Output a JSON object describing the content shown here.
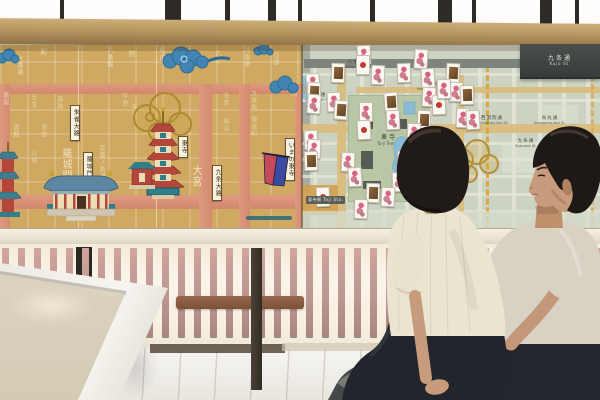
{
  "colors": {
    "beam_wood": "#b6945e",
    "historical_map_bg": "#cfa961",
    "historical_road": "#d48a6f",
    "modern_map_bg": "#ccd3c3",
    "modern_tan_street": "#d9bd7e",
    "park_green": "#b9c7a6",
    "water_blue": "#8fc0d8",
    "cloud_blue": "#4285b2",
    "pagoda_red": "#b4473c",
    "accent_teal": "#2e7f8a",
    "baluster_pink": "#bd968e",
    "bench_gray": "#45484b",
    "woman_top_cream": "#ebe4d1",
    "man_tee_gray": "#d8d2c4"
  },
  "room": {
    "window_mullions": [
      {
        "x": 60,
        "w": 4
      },
      {
        "x": 165,
        "w": 16
      },
      {
        "x": 225,
        "w": 5
      },
      {
        "x": 268,
        "w": 8
      },
      {
        "x": 298,
        "w": 4
      },
      {
        "x": 370,
        "w": 5
      },
      {
        "x": 438,
        "w": 14
      },
      {
        "x": 472,
        "w": 4
      },
      {
        "x": 540,
        "w": 12
      },
      {
        "x": 575,
        "w": 4
      }
    ]
  },
  "mural": {
    "historical_map": {
      "labels": [
        {
          "x": 70,
          "y": 60,
          "text": "朱雀大路"
        },
        {
          "x": 83,
          "y": 107,
          "text": "羅城門"
        },
        {
          "x": 178,
          "y": 91,
          "text": "東寺"
        },
        {
          "x": 212,
          "y": 120,
          "text": "九条大路"
        },
        {
          "x": 285,
          "y": 93,
          "text": "いまの東寺"
        }
      ],
      "kanji": [
        {
          "x": 40,
          "y": 3,
          "t": "町",
          "s": 7,
          "o": 0.7
        },
        {
          "x": 106,
          "y": 2,
          "t": "八条殿",
          "s": 6,
          "o": 0.75
        },
        {
          "x": 128,
          "y": 5,
          "t": "館",
          "s": 7,
          "o": 0.6
        },
        {
          "x": 158,
          "y": 2,
          "t": "相國",
          "s": 6,
          "o": 0.55
        },
        {
          "x": 186,
          "y": 4,
          "t": "清華",
          "s": 6,
          "o": 0.6
        },
        {
          "x": 214,
          "y": 5,
          "t": "六位",
          "s": 6,
          "o": 0.55
        },
        {
          "x": 243,
          "y": 2,
          "t": "兵庫寮",
          "s": 6,
          "o": 0.6
        },
        {
          "x": 272,
          "y": 7,
          "t": "信濃",
          "s": 6,
          "o": 0.55
        },
        {
          "x": 16,
          "y": 10,
          "t": "大膳職",
          "s": 6,
          "o": 0.6
        },
        {
          "x": 2,
          "y": 47,
          "t": "嘉殿",
          "s": 6,
          "o": 0.6
        },
        {
          "x": 30,
          "y": 49,
          "t": "壬生",
          "s": 6,
          "o": 0.55
        },
        {
          "x": 56,
          "y": 51,
          "t": "斎院",
          "s": 6,
          "o": 0.6
        },
        {
          "x": 121,
          "y": 48,
          "t": "平野",
          "s": 6,
          "o": 0.5
        },
        {
          "x": 130,
          "y": 59,
          "t": "平等",
          "s": 6,
          "o": 0.6
        },
        {
          "x": 222,
          "y": 47,
          "t": "左京",
          "s": 6,
          "o": 0.6
        },
        {
          "x": 250,
          "y": 45,
          "t": "九条院",
          "s": 6,
          "o": 0.6
        },
        {
          "x": 290,
          "y": 45,
          "t": "院",
          "s": 6,
          "o": 0.5
        },
        {
          "x": 12,
          "y": 79,
          "t": "酒殿",
          "s": 6,
          "o": 0.6
        },
        {
          "x": 40,
          "y": 79,
          "t": "朝堂",
          "s": 6,
          "o": 0.5
        },
        {
          "x": 98,
          "y": 100,
          "t": "花薗ノ馬場",
          "s": 6,
          "o": 0.65
        },
        {
          "x": 222,
          "y": 73,
          "t": "納言",
          "s": 6,
          "o": 0.55
        },
        {
          "x": 250,
          "y": 71,
          "t": "御倉町",
          "s": 6,
          "o": 0.55
        },
        {
          "x": 30,
          "y": 105,
          "t": "斗帳",
          "s": 6,
          "o": 0.5
        },
        {
          "x": 128,
          "y": 123,
          "t": "針",
          "s": 6,
          "o": 0.5
        },
        {
          "x": 60,
          "y": 103,
          "t": "羅城門",
          "s": 10,
          "o": 0.8
        },
        {
          "x": 190,
          "y": 120,
          "t": "大宮",
          "s": 10,
          "o": 0.85
        },
        {
          "x": 279,
          "y": 117,
          "t": "堀川",
          "s": 9,
          "o": 0.8
        }
      ]
    },
    "modern_map": {
      "sign": {
        "kanji": "九条通",
        "latin": "Kujo St."
      },
      "park_label": {
        "kanji": "東寺",
        "latin": "To-ji Temple"
      },
      "station_label": {
        "kanji": "東寺駅",
        "latin": "Toji Sta."
      },
      "street_labels": [
        {
          "x": 318,
          "y": 94,
          "kanji": "大宮通",
          "latin": "Omiya-dori St."
        },
        {
          "x": 356,
          "y": 61,
          "kanji": "八条通",
          "latin": "Hachijo-dori St."
        },
        {
          "x": 432,
          "y": 83,
          "kanji": "堀川通",
          "latin": "Horikawa-dori St."
        },
        {
          "x": 492,
          "y": 117,
          "kanji": "西洞院通",
          "latin": "Nishinotoin-dori St."
        },
        {
          "x": 550,
          "y": 117,
          "kanji": "烏丸通",
          "latin": "Karasuma-dori St."
        },
        {
          "x": 526,
          "y": 140,
          "kanji": "九条通",
          "latin": "Kujo-dori St."
        }
      ],
      "cards": [
        {
          "x": 363,
          "y": 54,
          "r": -3,
          "t": "p"
        },
        {
          "x": 337,
          "y": 72,
          "r": 2,
          "t": "f"
        },
        {
          "x": 420,
          "y": 58,
          "r": 4,
          "t": "p"
        },
        {
          "x": 403,
          "y": 72,
          "r": -2,
          "t": "p"
        },
        {
          "x": 452,
          "y": 72,
          "r": 3,
          "t": "f"
        },
        {
          "x": 312,
          "y": 82,
          "r": -4,
          "t": "p"
        },
        {
          "x": 377,
          "y": 74,
          "r": 2,
          "t": "p"
        },
        {
          "x": 362,
          "y": 64,
          "r": 0,
          "t": "s"
        },
        {
          "x": 427,
          "y": 77,
          "r": -3,
          "t": "p"
        },
        {
          "x": 455,
          "y": 91,
          "r": 2,
          "t": "p"
        },
        {
          "x": 466,
          "y": 94,
          "r": -2,
          "t": "f"
        },
        {
          "x": 313,
          "y": 91,
          "r": 3,
          "t": "f"
        },
        {
          "x": 333,
          "y": 101,
          "r": -2,
          "t": "p"
        },
        {
          "x": 313,
          "y": 103,
          "r": 4,
          "t": "p"
        },
        {
          "x": 365,
          "y": 111,
          "r": 0,
          "t": "p"
        },
        {
          "x": 390,
          "y": 101,
          "r": -4,
          "t": "f"
        },
        {
          "x": 428,
          "y": 96,
          "r": 3,
          "t": "p"
        },
        {
          "x": 438,
          "y": 104,
          "r": -2,
          "t": "s"
        },
        {
          "x": 462,
          "y": 117,
          "r": 2,
          "t": "p"
        },
        {
          "x": 472,
          "y": 119,
          "r": -3,
          "t": "p"
        },
        {
          "x": 423,
          "y": 119,
          "r": 2,
          "t": "f"
        },
        {
          "x": 392,
          "y": 119,
          "r": -2,
          "t": "p"
        },
        {
          "x": 340,
          "y": 109,
          "r": 4,
          "t": "f"
        },
        {
          "x": 310,
          "y": 139,
          "r": -2,
          "t": "p"
        },
        {
          "x": 313,
          "y": 148,
          "r": 3,
          "t": "p"
        },
        {
          "x": 363,
          "y": 129,
          "r": -3,
          "t": "s"
        },
        {
          "x": 413,
          "y": 132,
          "r": 2,
          "t": "p"
        },
        {
          "x": 430,
          "y": 140,
          "r": -4,
          "t": "p"
        },
        {
          "x": 403,
          "y": 160,
          "r": 2,
          "t": "p"
        },
        {
          "x": 310,
          "y": 160,
          "r": -2,
          "t": "f"
        },
        {
          "x": 347,
          "y": 161,
          "r": 3,
          "t": "p"
        },
        {
          "x": 354,
          "y": 176,
          "r": -3,
          "t": "p"
        },
        {
          "x": 372,
          "y": 192,
          "r": 2,
          "t": "f"
        },
        {
          "x": 398,
          "y": 181,
          "r": -2,
          "t": "p"
        },
        {
          "x": 387,
          "y": 196,
          "r": 3,
          "t": "p"
        },
        {
          "x": 322,
          "y": 196,
          "r": -2,
          "t": "s"
        },
        {
          "x": 360,
          "y": 208,
          "r": 2,
          "t": "p"
        },
        {
          "x": 443,
          "y": 88,
          "r": -2,
          "t": "p"
        }
      ]
    }
  }
}
